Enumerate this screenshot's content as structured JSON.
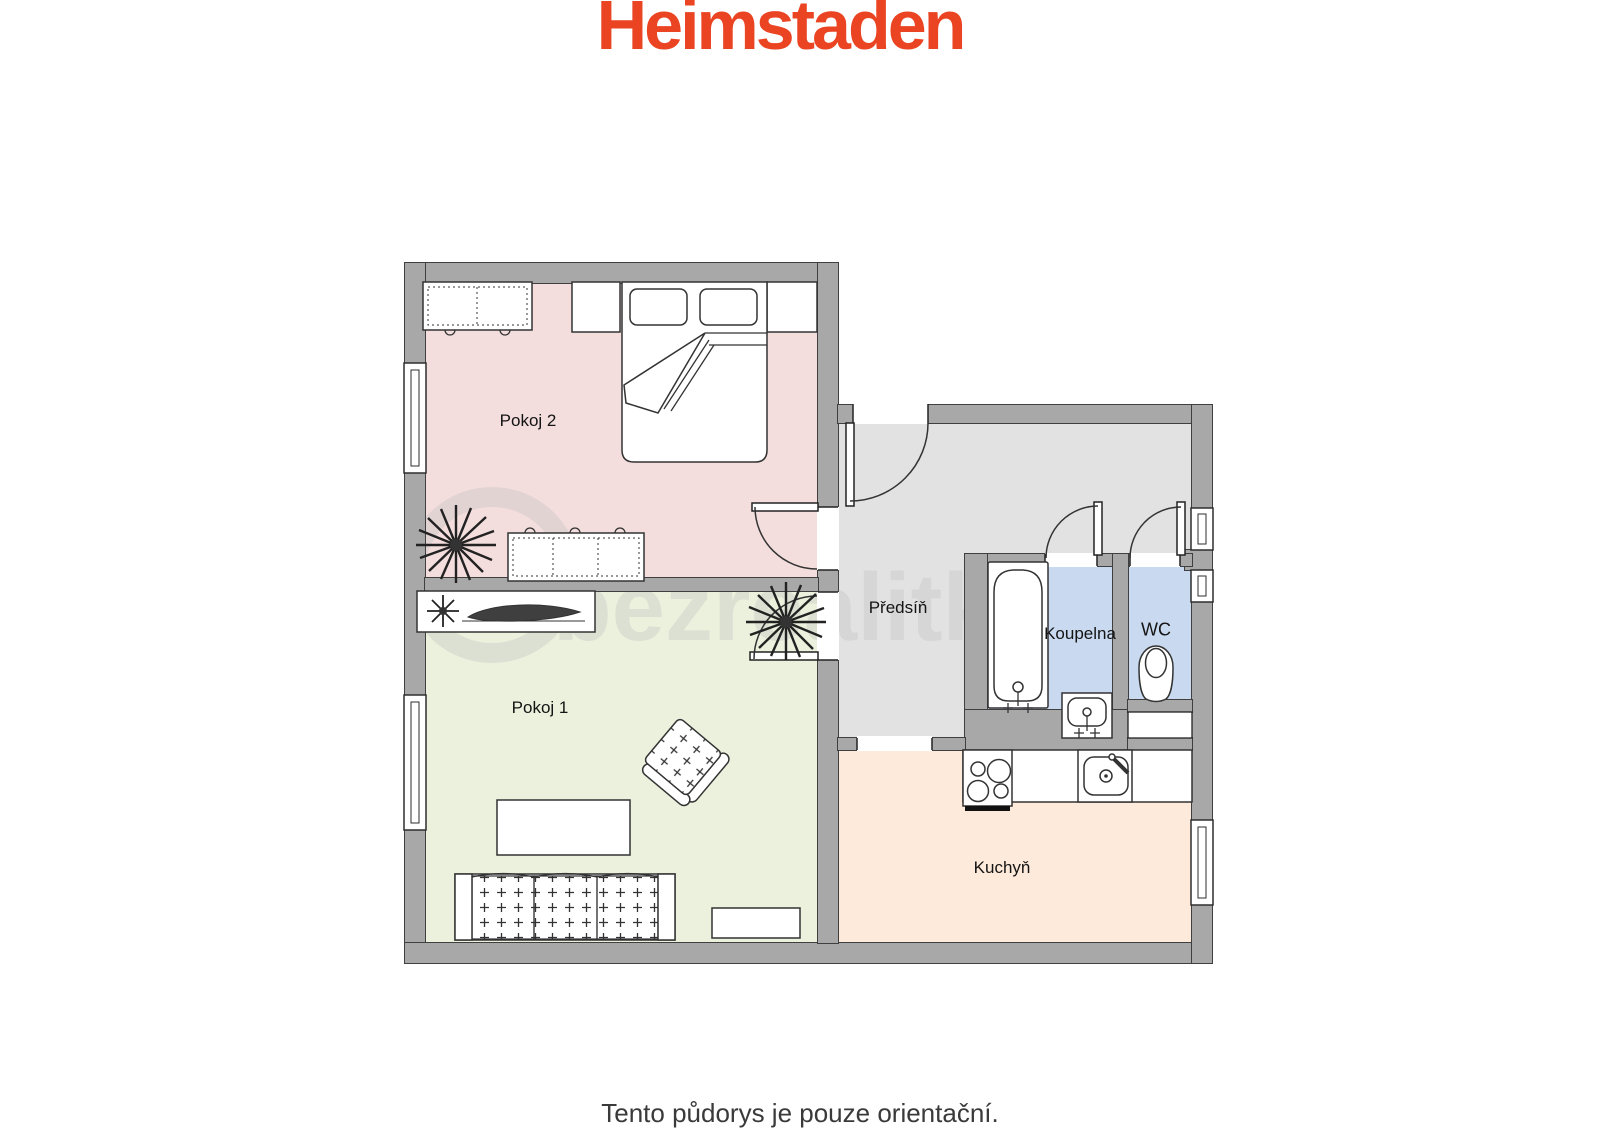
{
  "brand": {
    "logo_text": "Heimstaden",
    "logo_color": "#ea4423"
  },
  "floorplan": {
    "wall_color": "#a8a8a8",
    "watermark": "bezrealitky",
    "watermark_color": "#bdbdbd",
    "rooms": [
      {
        "id": "pokoj2",
        "label": "Pokoj 2",
        "color": "#f3dedd"
      },
      {
        "id": "pokoj1",
        "label": "Pokoj 1",
        "color": "#ebf1dd"
      },
      {
        "id": "predsin",
        "label": "Předsíň",
        "color": "#e3e2e2"
      },
      {
        "id": "koupelna",
        "label": "Koupelna",
        "color": "#c9daf0"
      },
      {
        "id": "wc",
        "label": "WC",
        "color": "#c9daf0"
      },
      {
        "id": "kuchyn",
        "label": "Kuchyň",
        "color": "#fdeadb"
      }
    ]
  },
  "footer": {
    "note": "Tento půdorys je pouze orientační."
  }
}
